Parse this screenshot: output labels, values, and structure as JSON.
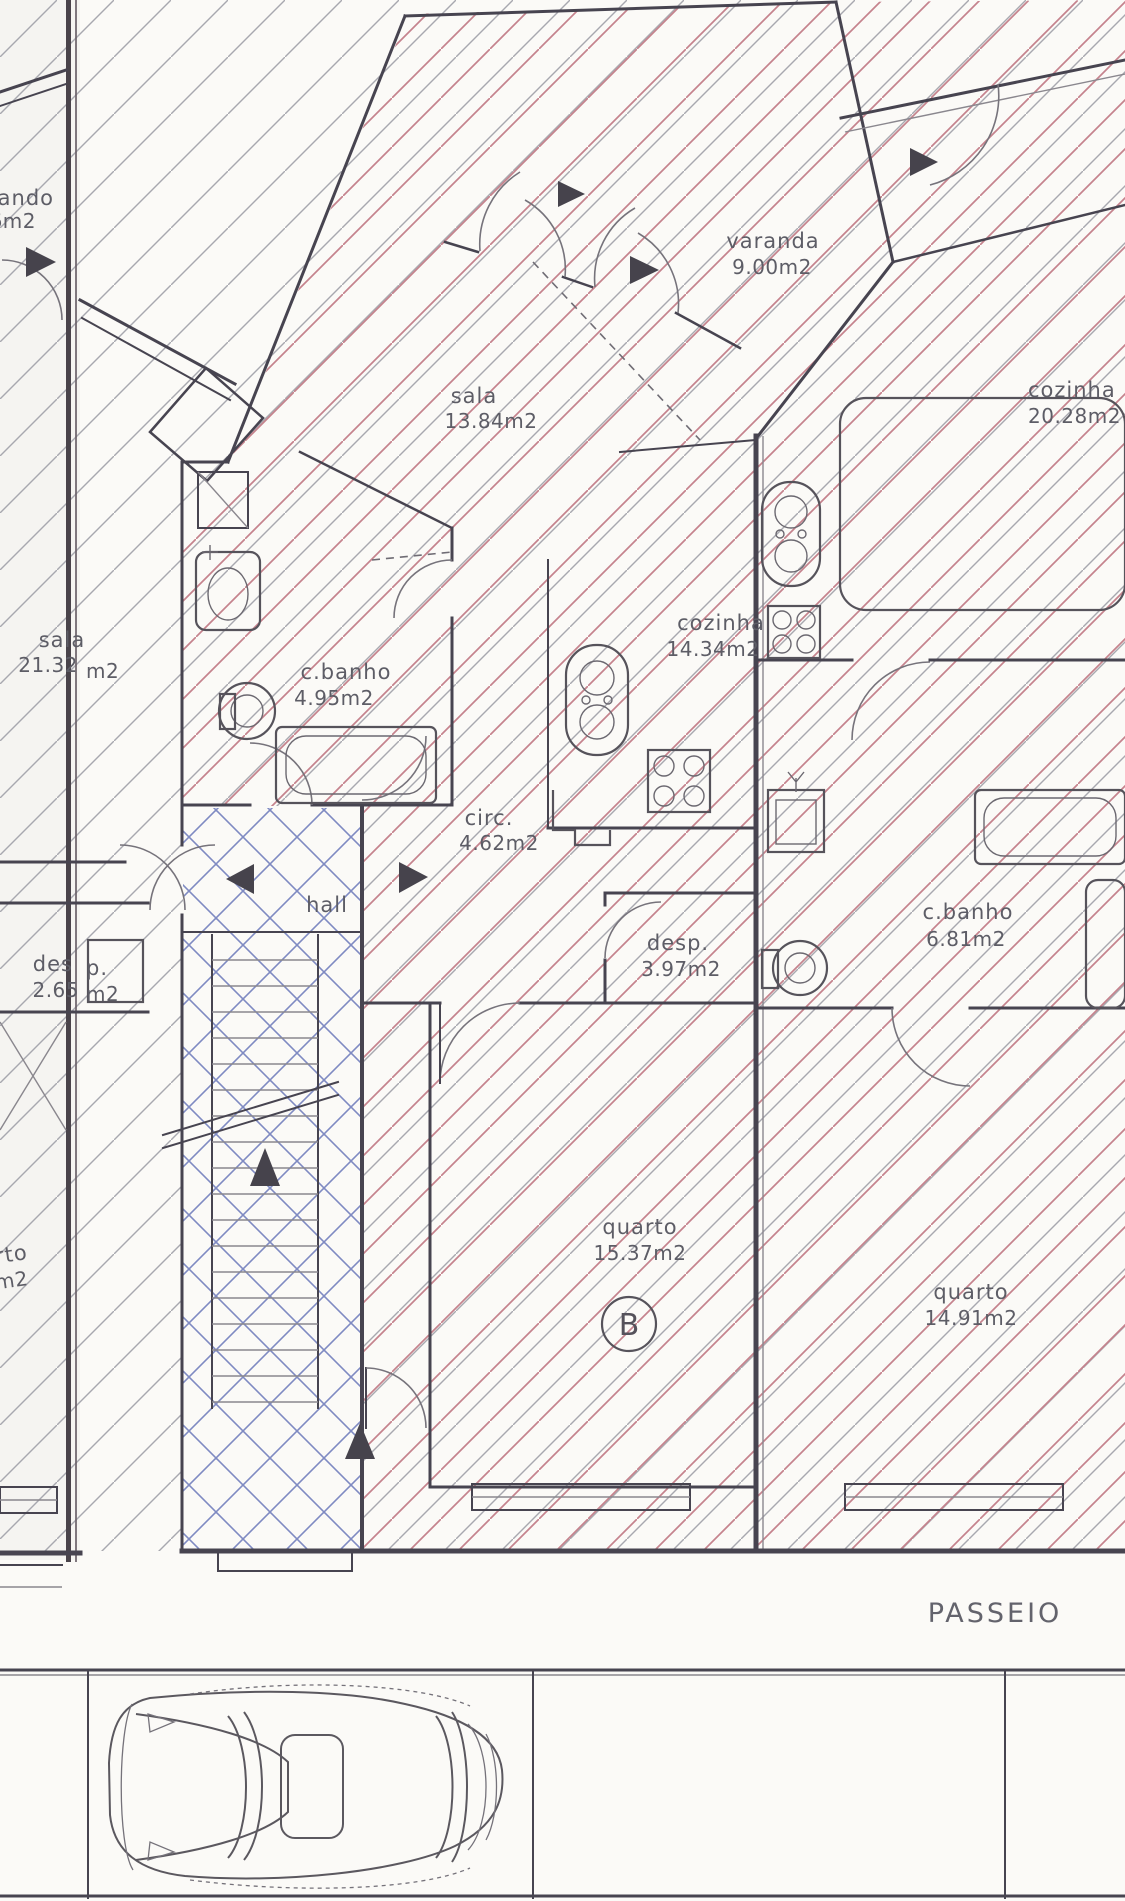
{
  "plan": {
    "unit_b": {
      "varanda": {
        "name": "varanda",
        "area": "9.00m2"
      },
      "sala": {
        "name": "sala",
        "area": "13.84m2"
      },
      "cozinha": {
        "name": "cozinha",
        "area": "14.34m2"
      },
      "cbanho": {
        "name": "c.banho",
        "area": "4.95m2"
      },
      "circ": {
        "name": "circ.",
        "area": "4.62m2"
      },
      "hall": {
        "name": "hall"
      },
      "desp": {
        "name": "desp.",
        "area": "3.97m2"
      },
      "quarto": {
        "name": "quarto",
        "area": "15.37m2"
      },
      "unit_letter": "B"
    },
    "unit_c": {
      "cozinha": {
        "name": "cozinha",
        "area": "20.28m2"
      },
      "cbanho": {
        "name": "c.banho",
        "area": "6.81m2"
      },
      "quarto": {
        "name": "quarto",
        "area": "14.91m2"
      }
    },
    "unit_a_partial": {
      "varanda_fragment": {
        "name": "ando",
        "area": "6m2"
      },
      "sala": {
        "name": "sala",
        "area_left": "21.32",
        "area_right": "m2"
      },
      "desp": {
        "name_left": "des",
        "name_right": "p.",
        "area_left": "2.65",
        "area_right": "m2"
      },
      "quarto_fragment": {
        "name": "rto",
        "area": "m2"
      }
    },
    "street": {
      "sidewalk_label": "PASSEIO"
    }
  },
  "colors": {
    "paper": "#fbfaf7",
    "wall": "#474450",
    "hatch_red": "#c5838d",
    "hatch_gray": "#a8a8af",
    "hatch_blue": "#7f8ac2",
    "label": "#5d5d66",
    "fold_line": "#49434a"
  }
}
